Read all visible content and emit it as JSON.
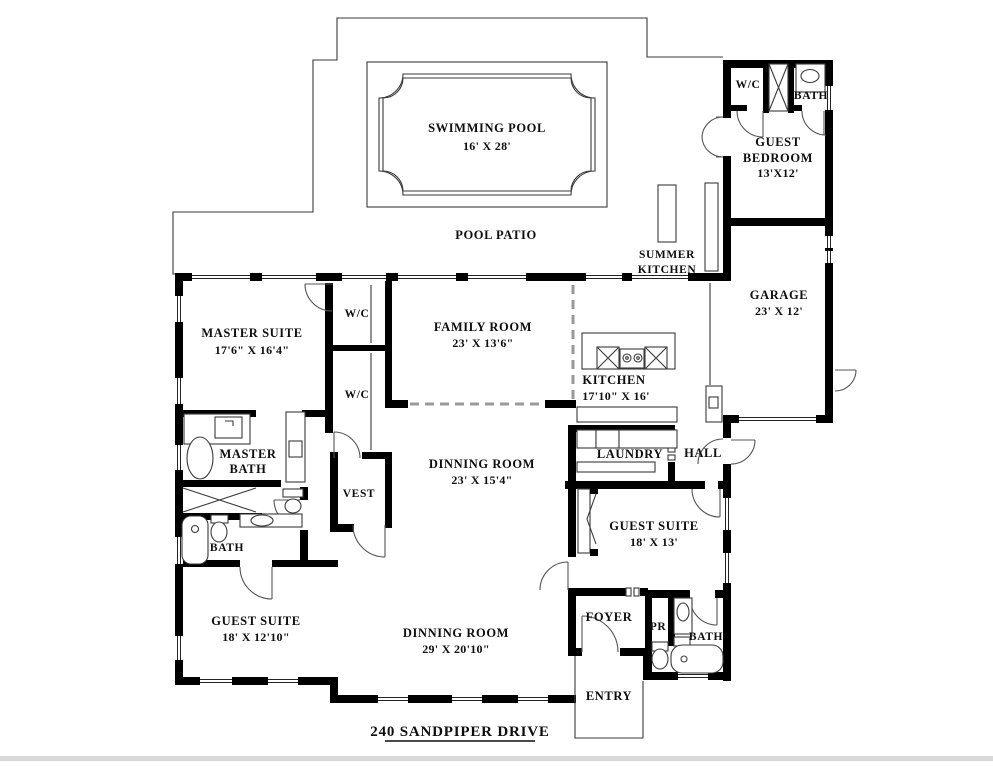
{
  "title": "240 SANDPIPER DRIVE",
  "colors": {
    "wall": "#000000",
    "line": "#3a3a3a",
    "dash": "#999999",
    "background": "#ffffff"
  },
  "rooms": {
    "swimming_pool": {
      "name": "SWIMMING POOL",
      "dims": "16' X 28'"
    },
    "pool_patio": {
      "name": "POOL PATIO"
    },
    "wc_guest": {
      "name": "W/C"
    },
    "bath_guest_top": {
      "name": "BATH"
    },
    "guest_bedroom": {
      "line1": "GUEST",
      "line2": "BEDROOM",
      "dims": "13'X12'"
    },
    "summer_kitchen": {
      "line1": "SUMMER",
      "line2": "KITCHEN"
    },
    "garage": {
      "name": "GARAGE",
      "dims": "23' X 12'"
    },
    "master_suite": {
      "name": "MASTER SUITE",
      "dims": "17'6\" X 16'4\""
    },
    "wc_1": {
      "name": "W/C"
    },
    "wc_2": {
      "name": "W/C"
    },
    "family_room": {
      "name": "FAMILY ROOM",
      "dims": "23' X 13'6\""
    },
    "kitchen": {
      "name": "KITCHEN",
      "dims": "17'10\" X 16'"
    },
    "master_bath": {
      "line1": "MASTER",
      "line2": "BATH"
    },
    "laundry": {
      "name": "LAUNDRY"
    },
    "hall": {
      "name": "HALL"
    },
    "vest": {
      "name": "VEST"
    },
    "dinning_room_upper": {
      "name": "DINNING ROOM",
      "dims": "23' X 15'4\""
    },
    "bath_left": {
      "name": "BATH"
    },
    "guest_suite_right": {
      "name": "GUEST SUITE",
      "dims": "18' X 13'"
    },
    "guest_suite_left": {
      "name": "GUEST SUITE",
      "dims": "18' X 12'10\""
    },
    "dinning_room_lower": {
      "name": "DINNING ROOM",
      "dims": "29' X 20'10\""
    },
    "foyer": {
      "name": "FOYER"
    },
    "pr": {
      "name": "PR"
    },
    "bath_right": {
      "name": "BATH"
    },
    "entry": {
      "name": "ENTRY"
    }
  }
}
